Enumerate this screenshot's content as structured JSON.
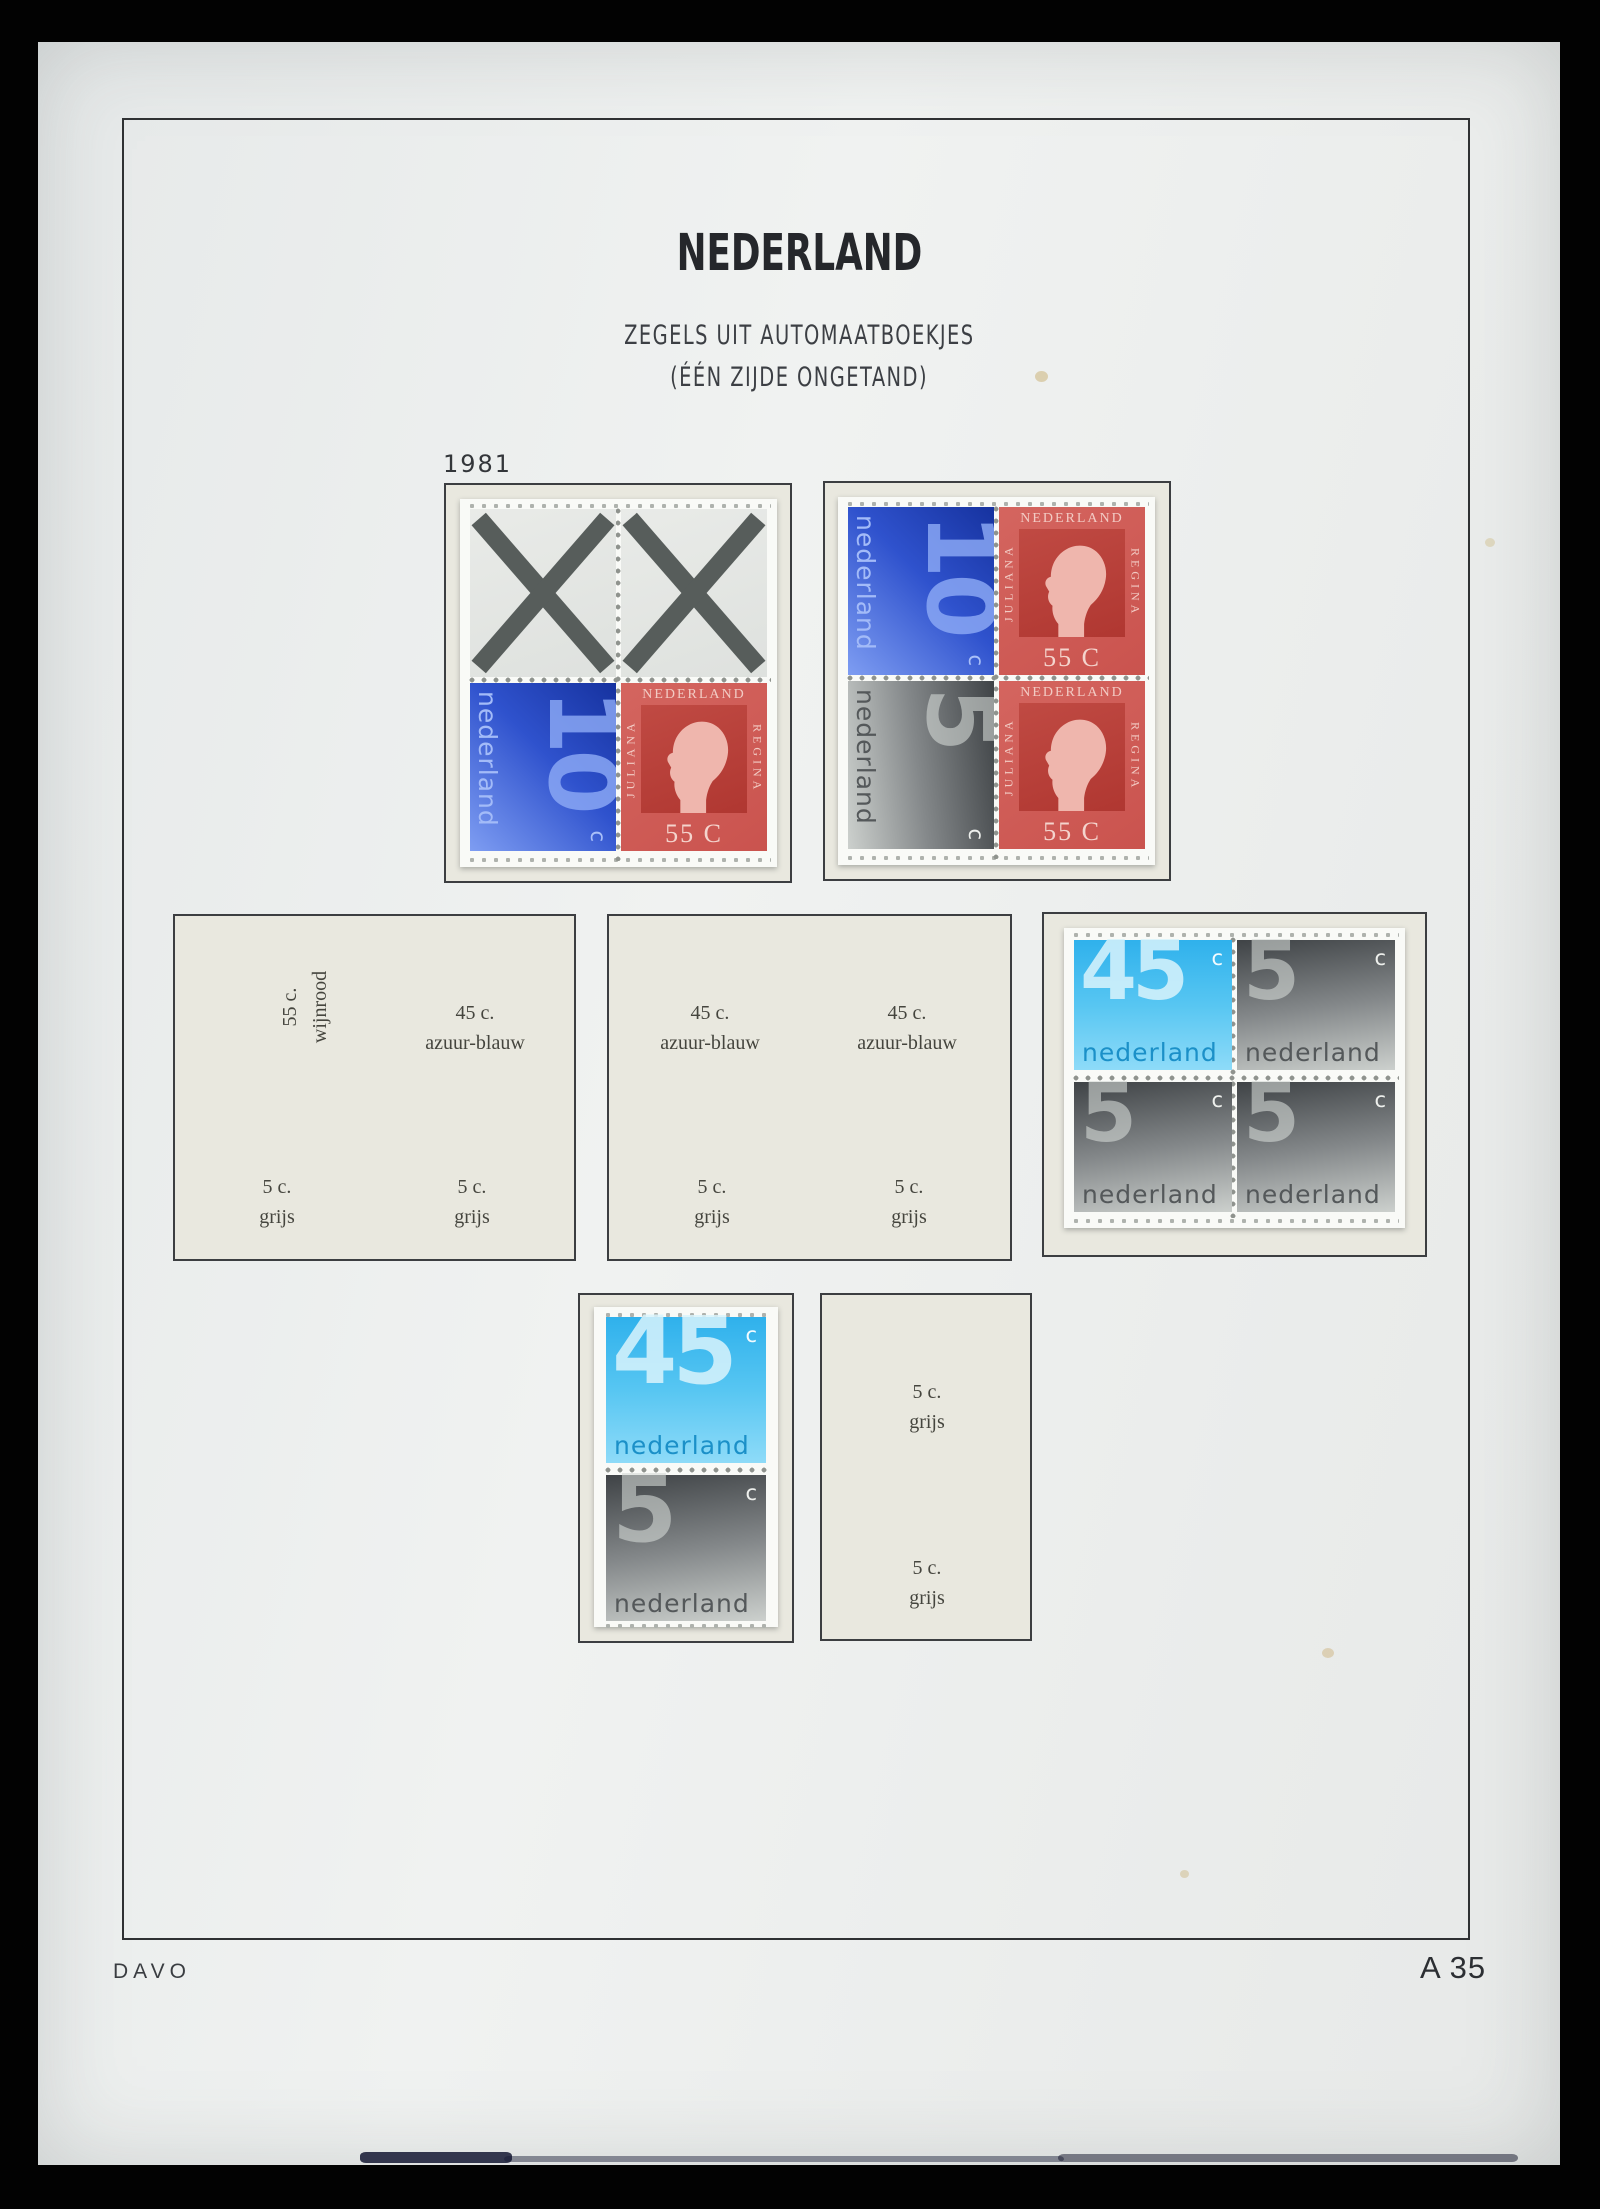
{
  "page": {
    "title": "NEDERLAND",
    "subtitle_line1": "ZEGELS UIT AUTOMAATBOEKJES",
    "subtitle_line2": "(ÉÉN ZIJDE ONGETAND)",
    "year_label": "1981",
    "publisher": "DAVO",
    "page_number": "A 35"
  },
  "colors": {
    "background": "#020202",
    "paper": "#eef0ef",
    "placeholder_paper": "#e9e8df",
    "stamp_blue_10c": "#2f52cd",
    "stamp_azure_45c": "#4cc2f1",
    "stamp_gray_5c": "#84888a",
    "stamp_red_55c": "#cf5a55",
    "cross_gray": "#575d5b"
  },
  "stamps": {
    "blue10": {
      "value": "10",
      "currency": "c",
      "country": "nederland"
    },
    "gray5": {
      "value": "5",
      "currency": "c",
      "country": "nederland"
    },
    "azure45": {
      "value": "45",
      "currency": "c",
      "country": "nederland"
    },
    "juliana55": {
      "country": "NEDERLAND",
      "left_title": "JULIANA",
      "right_title": "REGINA",
      "denomination": "55 C"
    }
  },
  "placeholders": {
    "box_left": {
      "top_left": {
        "line1": "55 c.",
        "line2": "wijnrood",
        "orientation": "vertical"
      },
      "top_right": {
        "line1": "45 c.",
        "line2": "azuur-blauw"
      },
      "bottom_left": {
        "line1": "5 c.",
        "line2": "grijs"
      },
      "bottom_right": {
        "line1": "5 c.",
        "line2": "grijs"
      }
    },
    "box_middle": {
      "top_left": {
        "line1": "45 c.",
        "line2": "azuur-blauw"
      },
      "top_right": {
        "line1": "45 c.",
        "line2": "azuur-blauw"
      },
      "bottom_left": {
        "line1": "5 c.",
        "line2": "grijs"
      },
      "bottom_right": {
        "line1": "5 c.",
        "line2": "grijs"
      }
    },
    "box_bottom_right": {
      "top": {
        "line1": "5 c.",
        "line2": "grijs"
      },
      "bottom": {
        "line1": "5 c.",
        "line2": "grijs"
      }
    }
  }
}
